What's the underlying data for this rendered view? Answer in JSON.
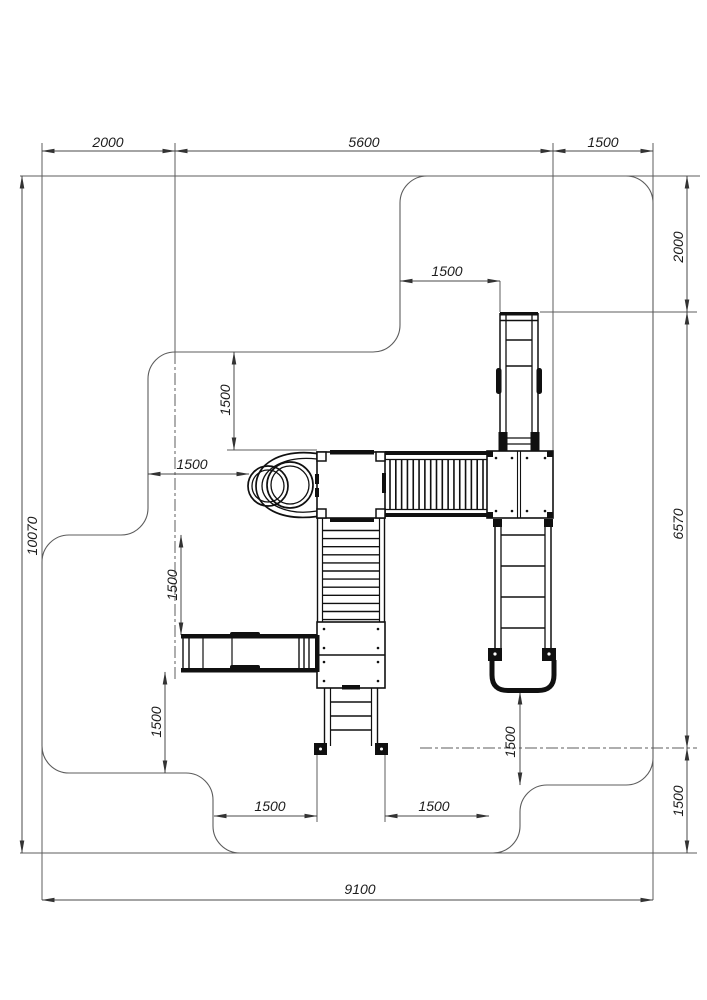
{
  "drawing": {
    "kind": "playground-equipment-plan",
    "units_implied": "mm",
    "colors": {
      "background": "#ffffff",
      "thin_line": "#5c5c5c",
      "equipment_line": "#101010",
      "text": "#1c1c1c"
    },
    "components": [
      "safety-zone-outline",
      "tube-slide",
      "main-platform",
      "slat-bridge",
      "right-platform",
      "top-climb-ladder",
      "right-ladder-with-handle",
      "stairs",
      "landing-platform",
      "bottom-ladder",
      "monkey-bar-beam"
    ]
  },
  "dimensions": {
    "top": {
      "d2000": "2000",
      "d5600": "5600",
      "d1500": "1500"
    },
    "right": {
      "d2000": "2000",
      "d6570": "6570",
      "d1500": "1500"
    },
    "left": {
      "d10070": "10070"
    },
    "bottom": {
      "d9100": "9100"
    },
    "internal": {
      "ladder_top": "1500",
      "platform_upper": "1500",
      "slide": "1500",
      "beam_upper": "1500",
      "beam_lower": "1500",
      "bottom_left": "1500",
      "bottom_right": "1500",
      "handle": "1500"
    }
  }
}
